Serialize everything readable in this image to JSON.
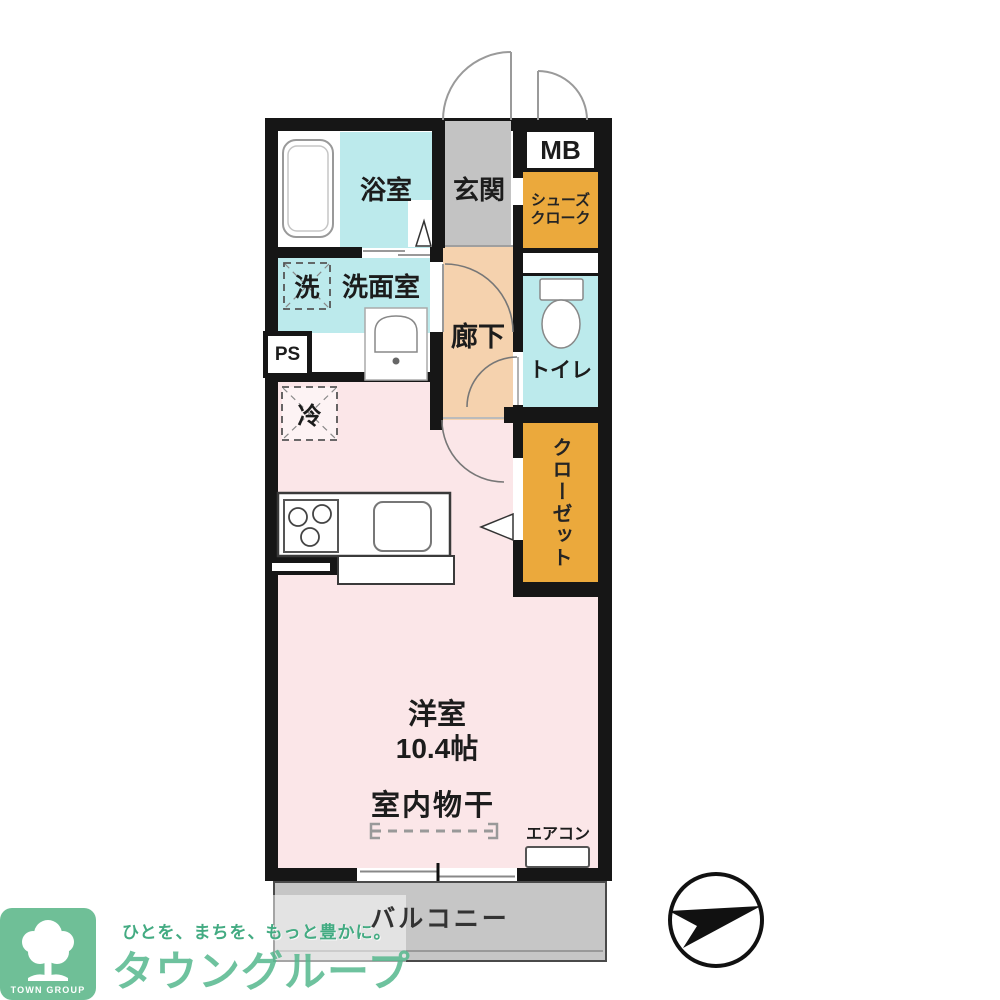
{
  "labels": {
    "bath": "浴室",
    "entrance": "玄関",
    "meter_box": "MB",
    "shoe_line1": "シューズ",
    "shoe_line2": "クローク",
    "washer": "洗",
    "washroom": "洗面室",
    "pipe_space": "PS",
    "hallway": "廊下",
    "toilet": "トイレ",
    "fridge": "冷",
    "closet": "クローゼット",
    "main_room": "洋室",
    "main_room_size": "10.4帖",
    "indoor_drying": "室内物干",
    "aircon": "エアコン",
    "balcony": "バルコニー"
  },
  "branding": {
    "tagline": "ひとを、まちを、もっと豊かに。",
    "company": "タウングループ",
    "badge": "TOWN GROUP"
  },
  "icons": {
    "bathtub": "bathtub-icon",
    "basin": "washbasin-icon",
    "toilet_bowl": "toilet-icon",
    "stove": "stove-burners-icon",
    "kitchen_sink": "kitchen-sink-icon",
    "door_arcs": "door-swing-arc",
    "compass": "north-arrow-compass",
    "tree": "town-group-tree-logo"
  },
  "colors": {
    "wall": "#161616",
    "wet_room_cyan": "#bceaec",
    "storage_orange": "#eba93c",
    "hallway_beige": "#f5d2ae",
    "room_pink": "#fbe6e8",
    "entrance_gray": "#c3c3c3",
    "balcony_gray": "#c6c6c6",
    "brand_green": "#55b78d"
  }
}
